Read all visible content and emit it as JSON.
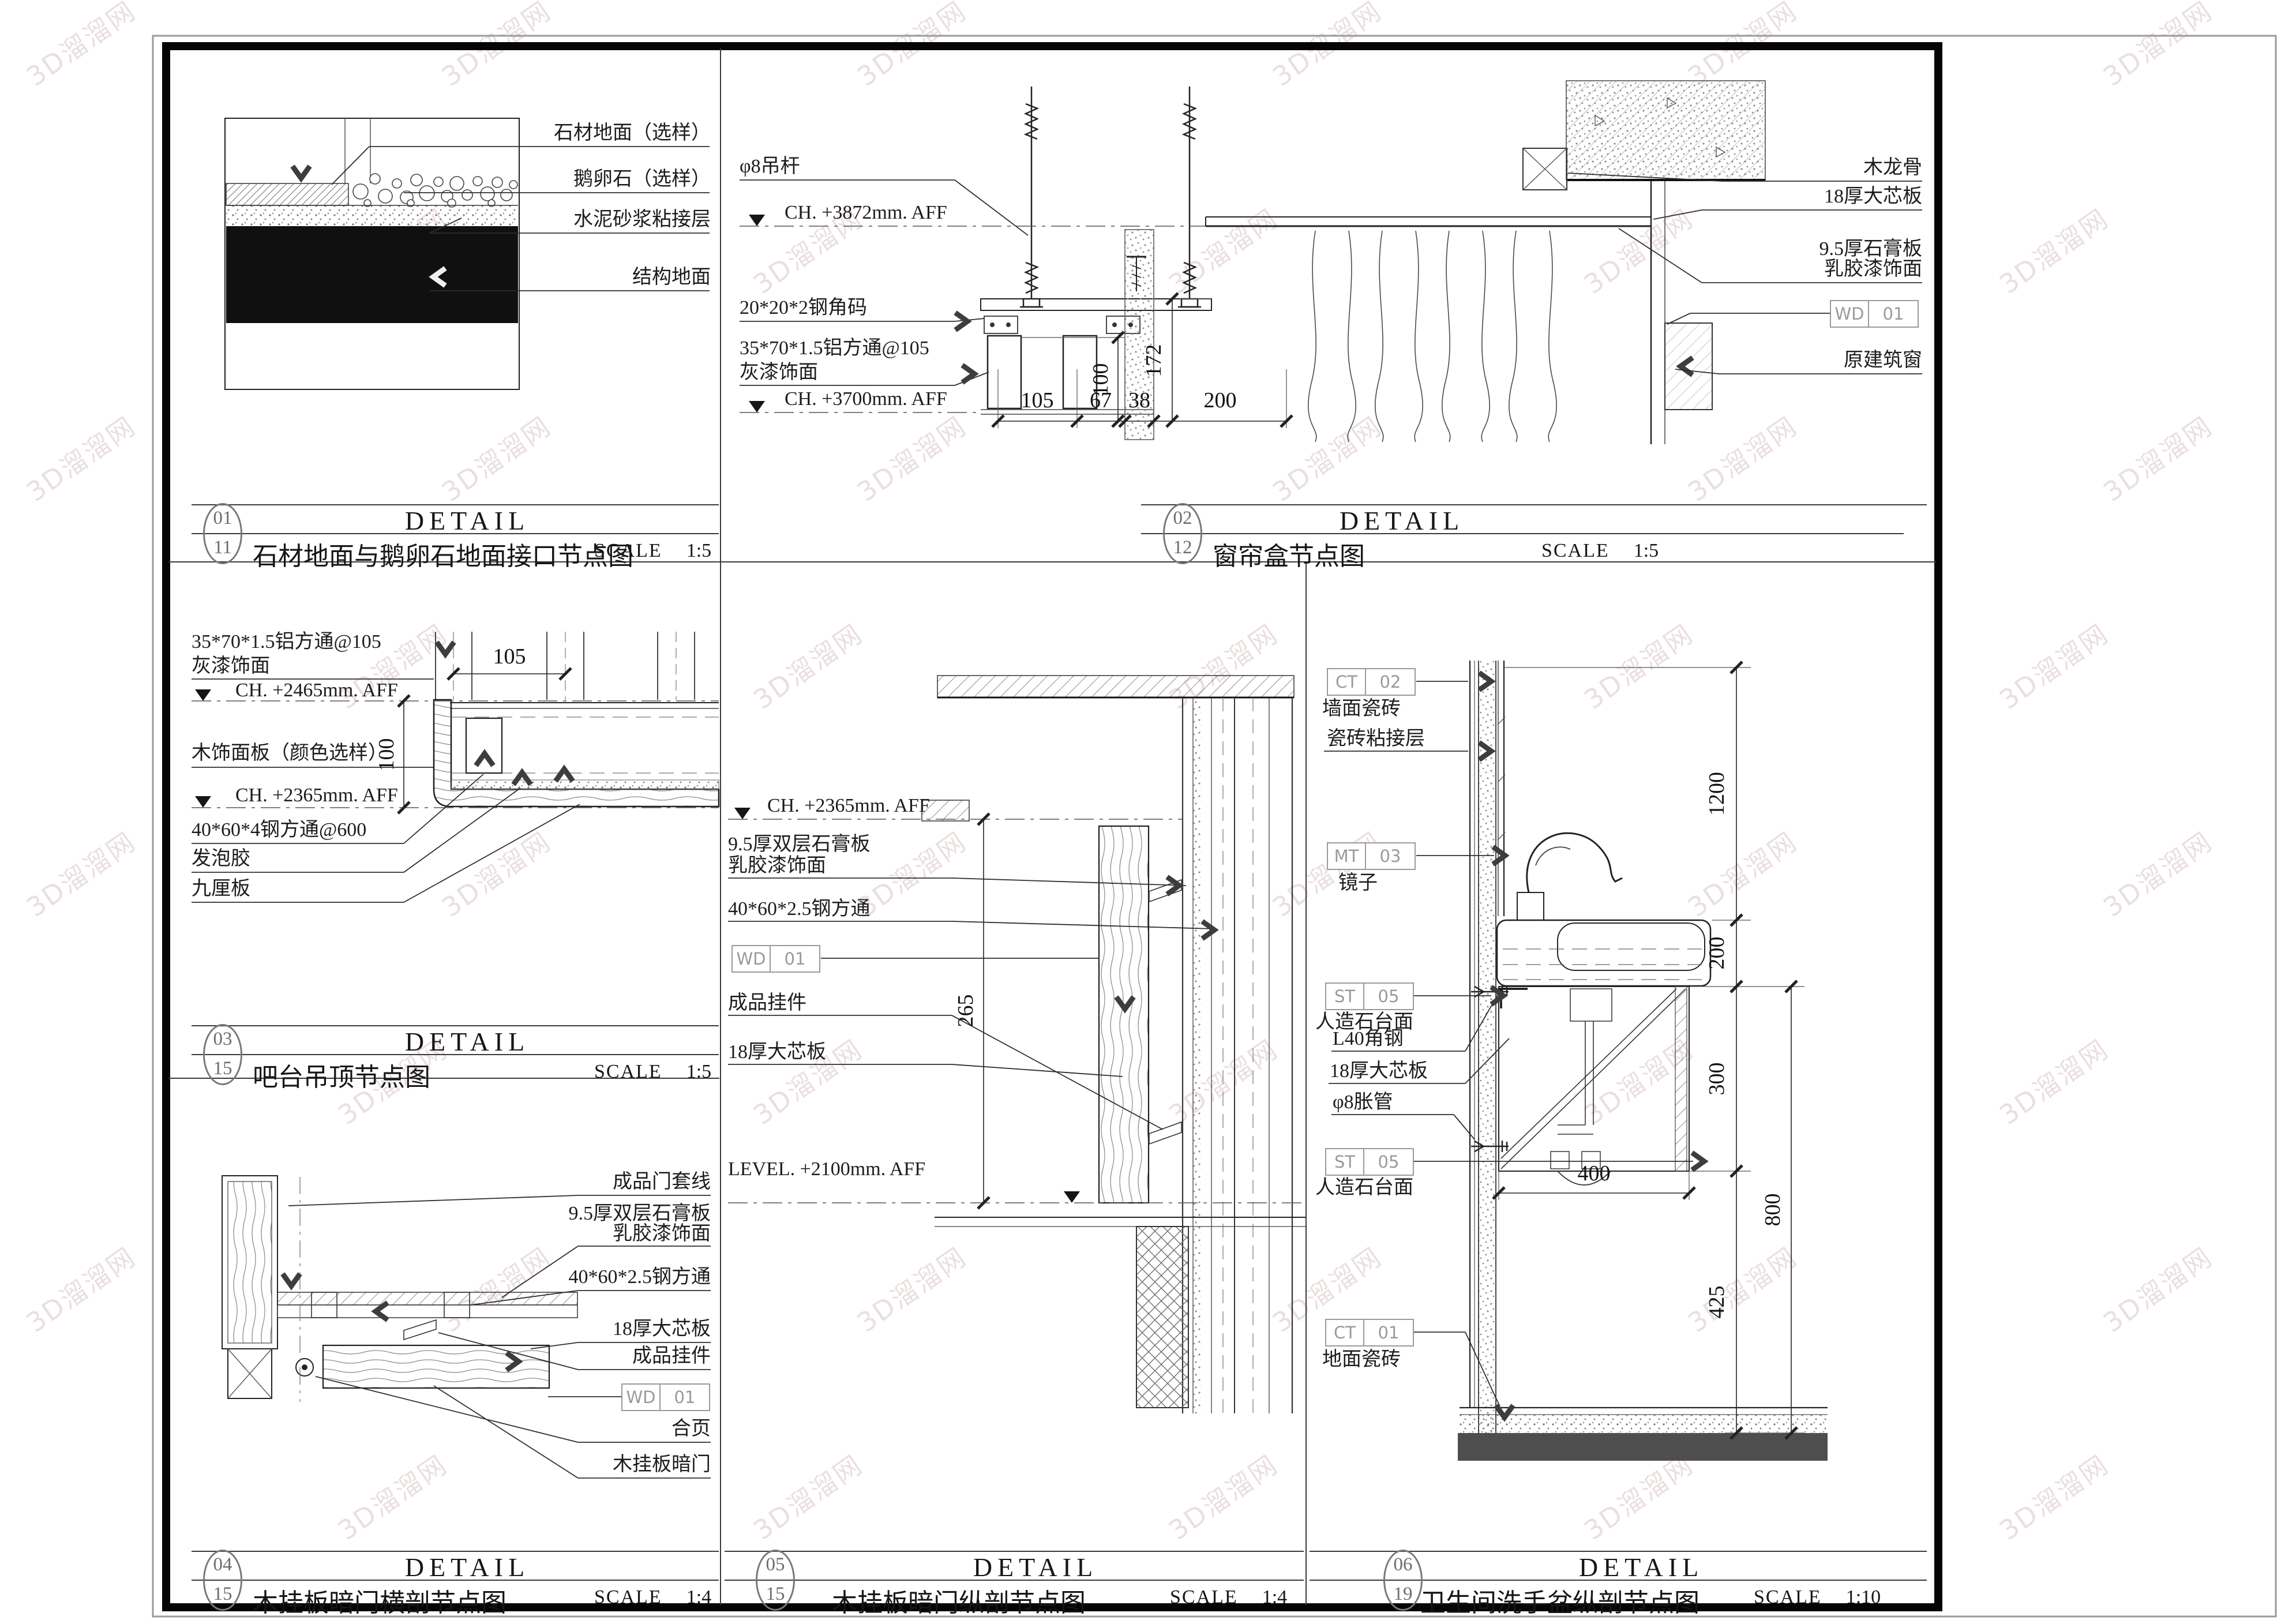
{
  "common": {
    "detail_word": "DETAIL",
    "scale_word": "SCALE"
  },
  "watermark": {
    "text": "3D溜溜网"
  },
  "p01": {
    "title": {
      "no": "01",
      "sub": "11",
      "name": "石材地面与鹅卵石地面接口节点图",
      "scale": "1:5"
    },
    "labels": {
      "stone": "石材地面（选样）",
      "pebble": "鹅卵石（选样）",
      "mortar": "水泥砂浆粘接层",
      "structure": "结构地面"
    }
  },
  "p02": {
    "title": {
      "no": "02",
      "sub": "12",
      "name": "窗帘盒节点图",
      "scale": "1:5"
    },
    "labels": {
      "rod": "φ8吊杆",
      "ch_top": "CH. +3872mm. AFF",
      "angle": "20*20*2钢角码",
      "alu1": "35*70*1.5铝方通@105",
      "alu2": "灰漆饰面",
      "ch_bot": "CH. +3700mm. AFF",
      "wood": "木龙骨",
      "board": "18厚大芯板",
      "gyp1": "9.5厚石膏板",
      "gyp2": "乳胶漆饰面",
      "window": "原建筑窗"
    },
    "tag": {
      "a": "WD",
      "b": "01"
    },
    "dims": {
      "d105": "105",
      "d67": "67",
      "d38": "38",
      "d200": "200",
      "d100": "100",
      "d172": "172"
    }
  },
  "p03": {
    "title": {
      "no": "03",
      "sub": "15",
      "name": "吧台吊顶节点图",
      "scale": "1:5"
    },
    "labels": {
      "alu1": "35*70*1.5铝方通@105",
      "alu2": "灰漆饰面",
      "ch1": "CH. +2465mm. AFF",
      "panel": "木饰面板（颜色选样）",
      "ch2": "CH. +2365mm. AFF",
      "steel": "40*60*4钢方通@600",
      "foam": "发泡胶",
      "board": "九厘板"
    },
    "dims": {
      "d105": "105",
      "d100": "100"
    }
  },
  "p04": {
    "title": {
      "no": "04",
      "sub": "15",
      "name": "木挂板暗门横剖节点图",
      "scale": "1:4"
    },
    "labels": {
      "casing": "成品门套线",
      "gyp1": "9.5厚双层石膏板",
      "gyp2": "乳胶漆饰面",
      "steel": "40*60*2.5钢方通",
      "board": "18厚大芯板",
      "hanger": "成品挂件",
      "hinge": "合页",
      "door": "木挂板暗门"
    },
    "tag": {
      "a": "WD",
      "b": "01"
    }
  },
  "p05": {
    "title": {
      "no": "05",
      "sub": "15",
      "name": "木挂板暗门纵剖节点图",
      "scale": "1:4"
    },
    "labels": {
      "ch": "CH. +2365mm. AFF",
      "gyp1": "9.5厚双层石膏板",
      "gyp2": "乳胶漆饰面",
      "steel": "40*60*2.5钢方通",
      "hanger": "成品挂件",
      "board": "18厚大芯板",
      "level": "LEVEL. +2100mm. AFF"
    },
    "tag": {
      "a": "WD",
      "b": "01"
    },
    "dims": {
      "d265": "265"
    }
  },
  "p06": {
    "title": {
      "no": "06",
      "sub": "19",
      "name": "卫生间洗手盆纵剖节点图",
      "scale": "1:10"
    },
    "labels": {
      "wall_tile": "墙面瓷砖",
      "adhesive": "瓷砖粘接层",
      "mirror": "镜子",
      "counter1": "人造石台面",
      "angle": "L40角钢",
      "board": "18厚大芯板",
      "anchor": "φ8胀管",
      "counter2": "人造石台面",
      "floor_tile": "地面瓷砖"
    },
    "tags": {
      "ct02a": "CT",
      "ct02b": "02",
      "mt03a": "MT",
      "mt03b": "03",
      "st05a": "ST",
      "st05b": "05",
      "st05c": "ST",
      "st05d": "05",
      "ct01a": "CT",
      "ct01b": "01"
    },
    "dims": {
      "d1200": "1200",
      "d200": "200",
      "d300": "300",
      "d425": "425",
      "d800": "800",
      "d400": "400"
    }
  }
}
